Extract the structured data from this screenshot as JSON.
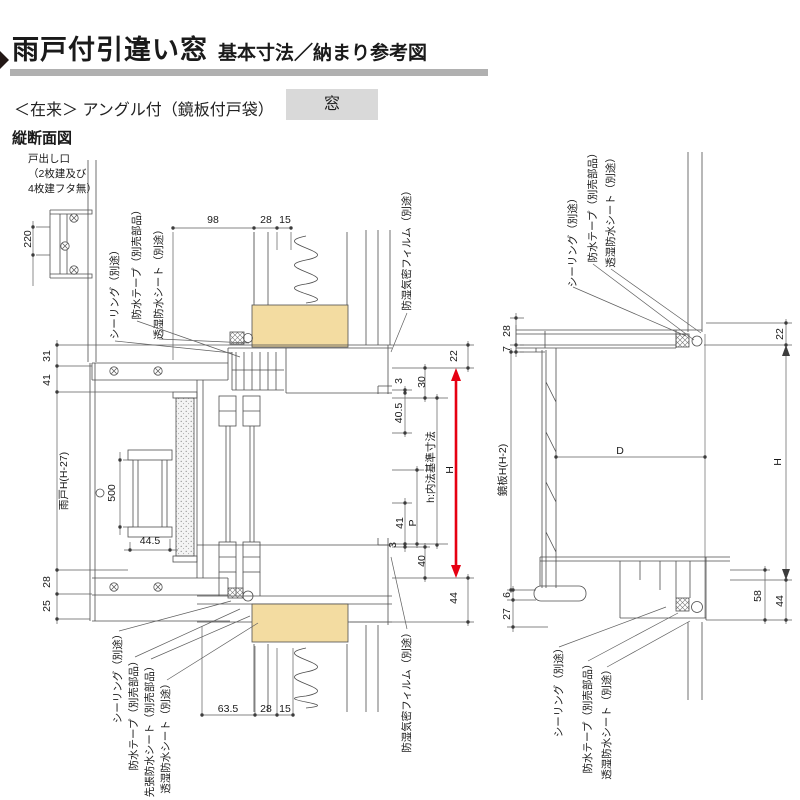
{
  "header": {
    "title_main": "雨戸付引違い窓",
    "title_sub": "基本寸法／納まり参考図",
    "spec_line": "＜在来＞ アングル付（鏡板付戸袋）",
    "spec_tag": "窓",
    "section_label": "縦断面図",
    "corner_note_lines": [
      "戸出し口",
      "（2枚建及び",
      "4枚建フタ無）"
    ]
  },
  "colors": {
    "dimension_red": "#e60012",
    "wood_fill": "#f3dca1",
    "title_bar_gray": "#b0b0b0",
    "tag_bg": "#d9d9d9"
  },
  "annotations": [
    {
      "name": "dim-220",
      "text": "220",
      "x": 23,
      "y": 239,
      "rot": true
    },
    {
      "name": "dim-98",
      "text": "98",
      "x": 213,
      "y": 215,
      "rot": false
    },
    {
      "name": "dim-28-head",
      "text": "28",
      "x": 266,
      "y": 215,
      "rot": false
    },
    {
      "name": "dim-15-head",
      "text": "15",
      "x": 285,
      "y": 215,
      "rot": false
    },
    {
      "name": "callout-sealing-left-top",
      "text": "シーリング（別途）",
      "x": 110,
      "y": 292,
      "rot": true
    },
    {
      "name": "callout-waterproof-tape-left-top",
      "text": "防水テープ（別売部品）",
      "x": 132,
      "y": 262,
      "rot": true
    },
    {
      "name": "callout-breathable-sheet-left-top",
      "text": "透湿防水シート（別途）",
      "x": 154,
      "y": 282,
      "rot": true
    },
    {
      "name": "callout-vapor-barrier-film-top",
      "text": "防湿気密フィルム（別途）",
      "x": 402,
      "y": 248,
      "rot": true
    },
    {
      "name": "dim-31",
      "text": "31",
      "x": 42,
      "y": 356,
      "rot": true
    },
    {
      "name": "dim-41-left",
      "text": "41",
      "x": 42,
      "y": 380,
      "rot": true
    },
    {
      "name": "dim-amado-height",
      "text": "雨戸H(H-27)",
      "x": 59,
      "y": 481,
      "rot": true
    },
    {
      "name": "dim-28-left",
      "text": "28",
      "x": 42,
      "y": 582,
      "rot": true
    },
    {
      "name": "dim-25",
      "text": "25",
      "x": 42,
      "y": 606,
      "rot": true
    },
    {
      "name": "dim-500",
      "text": "500",
      "x": 107,
      "y": 493,
      "rot": true
    },
    {
      "name": "dim-44-5",
      "text": "44.5",
      "x": 150,
      "y": 536,
      "rot": false
    },
    {
      "name": "dim-3-head",
      "text": "3",
      "x": 394,
      "y": 381,
      "rot": true
    },
    {
      "name": "dim-40-5",
      "text": "40.5",
      "x": 394,
      "y": 413,
      "rot": true
    },
    {
      "name": "dim-30",
      "text": "30",
      "x": 417,
      "y": 382,
      "rot": true
    },
    {
      "name": "dim-inner-standard",
      "text": "h:内法基準寸法",
      "x": 426,
      "y": 467,
      "rot": true
    },
    {
      "name": "dim-h-left-drawing",
      "text": "H",
      "x": 445,
      "y": 470,
      "rot": true
    },
    {
      "name": "dim-22-left-drawing",
      "text": "22",
      "x": 449,
      "y": 356,
      "rot": true
    },
    {
      "name": "dim-41-sill",
      "text": "41",
      "x": 395,
      "y": 523,
      "rot": true
    },
    {
      "name": "dim-p",
      "text": "P",
      "x": 408,
      "y": 523,
      "rot": true
    },
    {
      "name": "dim-3-sill",
      "text": "3",
      "x": 388,
      "y": 545,
      "rot": true
    },
    {
      "name": "dim-40",
      "text": "40",
      "x": 417,
      "y": 561,
      "rot": true
    },
    {
      "name": "dim-44-left-drawing",
      "text": "44",
      "x": 449,
      "y": 598,
      "rot": true
    },
    {
      "name": "dim-63-5",
      "text": "63.5",
      "x": 228,
      "y": 704,
      "rot": false
    },
    {
      "name": "dim-28-sill",
      "text": "28",
      "x": 266,
      "y": 704,
      "rot": false
    },
    {
      "name": "dim-15-sill",
      "text": "15",
      "x": 285,
      "y": 704,
      "rot": false
    },
    {
      "name": "callout-sealing-left-bottom",
      "text": "シーリング（別途）",
      "x": 113,
      "y": 676,
      "rot": true
    },
    {
      "name": "callout-waterproof-tape-left-bottom",
      "text": "防水テープ（別売部品）",
      "x": 129,
      "y": 713,
      "rot": true
    },
    {
      "name": "callout-pre-applied-waterproof-sheet",
      "text": "先張防水シート（別売部品）",
      "x": 145,
      "y": 729,
      "rot": true
    },
    {
      "name": "callout-breathable-sheet-left-bottom",
      "text": "透湿防水シート（別途）",
      "x": 161,
      "y": 736,
      "rot": true
    },
    {
      "name": "callout-vapor-barrier-film-bottom",
      "text": "防湿気密フィルム（別途）",
      "x": 402,
      "y": 690,
      "rot": true
    },
    {
      "name": "callout-sealing-right-top",
      "text": "シーリング（別途）",
      "x": 568,
      "y": 240,
      "rot": true
    },
    {
      "name": "callout-waterproof-tape-right-top",
      "text": "防水テープ（別売部品）",
      "x": 588,
      "y": 205,
      "rot": true
    },
    {
      "name": "callout-breathable-sheet-right-top",
      "text": "透湿防水シート（別途）",
      "x": 606,
      "y": 210,
      "rot": true
    },
    {
      "name": "dim-28-right-drawing",
      "text": "28",
      "x": 502,
      "y": 331,
      "rot": true
    },
    {
      "name": "dim-7",
      "text": "7",
      "x": 502,
      "y": 349,
      "rot": true
    },
    {
      "name": "dim-kagamiita-height",
      "text": "鏡板H(H-2)",
      "x": 498,
      "y": 470,
      "rot": true
    },
    {
      "name": "dim-d",
      "text": "D",
      "x": 620,
      "y": 446,
      "rot": false
    },
    {
      "name": "dim-h-right-drawing",
      "text": "H",
      "x": 773,
      "y": 462,
      "rot": true
    },
    {
      "name": "dim-22-right-drawing",
      "text": "22",
      "x": 775,
      "y": 334,
      "rot": true
    },
    {
      "name": "dim-58",
      "text": "58",
      "x": 753,
      "y": 596,
      "rot": true
    },
    {
      "name": "dim-44-right-drawing",
      "text": "44",
      "x": 775,
      "y": 601,
      "rot": true
    },
    {
      "name": "dim-6",
      "text": "6",
      "x": 502,
      "y": 595,
      "rot": true
    },
    {
      "name": "dim-27",
      "text": "27",
      "x": 502,
      "y": 614,
      "rot": true
    },
    {
      "name": "callout-sealing-right-bottom",
      "text": "シーリング（別途）",
      "x": 554,
      "y": 690,
      "rot": true
    },
    {
      "name": "callout-waterproof-tape-right-bottom",
      "text": "防水テープ（別売部品）",
      "x": 583,
      "y": 716,
      "rot": true
    },
    {
      "name": "callout-breathable-sheet-right-bottom",
      "text": "透湿防水シート（別途）",
      "x": 602,
      "y": 722,
      "rot": true
    }
  ]
}
